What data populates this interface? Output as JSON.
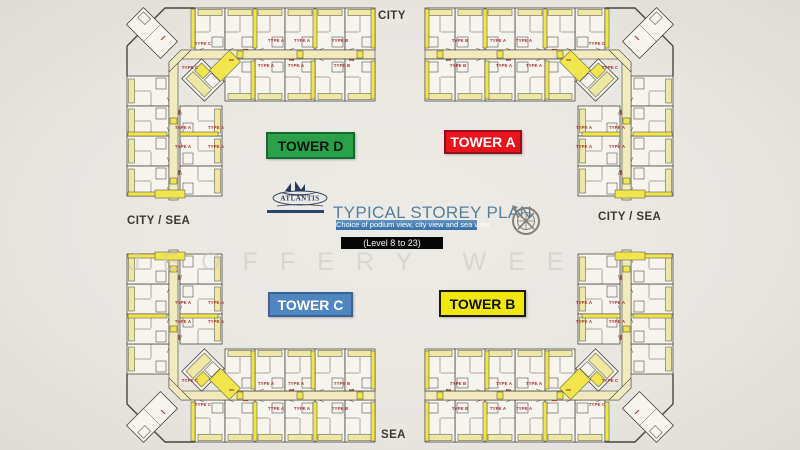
{
  "orientation": {
    "top": "CITY",
    "bottom": "SEA",
    "left": "CITY / SEA",
    "right": "CITY / SEA"
  },
  "towers": {
    "d": "TOWER D",
    "a": "TOWER A",
    "c": "TOWER C",
    "b": "TOWER B"
  },
  "branding": {
    "logo_text": "ATLANTIS",
    "title": "TYPICAL STOREY PLAN",
    "subtitle": "Choice of podium view, city view and sea view",
    "level_range": "(Level 8 to 23)"
  },
  "watermark": {
    "text": "JEOFFERY WEE"
  },
  "icons": {
    "compass": "compass-rose-icon"
  },
  "colors": {
    "tower_d": "#2aa148",
    "tower_a": "#e8131b",
    "tower_c": "#4f86c0",
    "tower_b": "#f0e70c",
    "title_text": "#54809e",
    "banner_bg": "#356fa6",
    "level_badge_bg": "#070707",
    "plan_highlight_yellow": "#f1e54e",
    "plan_pale_yellow": "#efe8a2",
    "plan_line": "#4a473e",
    "unit_label_red": "#ab352c",
    "background": "#e9e7e2"
  },
  "plan": {
    "unit_labels": [
      {
        "label": "TYPE C",
        "x": 203,
        "y": 45
      },
      {
        "label": "TYPE C",
        "x": 190,
        "y": 69
      },
      {
        "label": "TYPE A",
        "x": 276,
        "y": 42
      },
      {
        "label": "TYPE A",
        "x": 302,
        "y": 42
      },
      {
        "label": "TYPE A",
        "x": 266,
        "y": 67
      },
      {
        "label": "TYPE A",
        "x": 296,
        "y": 67
      },
      {
        "label": "TYPE B",
        "x": 340,
        "y": 42
      },
      {
        "label": "TYPE B",
        "x": 342,
        "y": 67
      },
      {
        "label": "TYPE A",
        "x": 183,
        "y": 129
      },
      {
        "label": "TYPE A",
        "x": 216,
        "y": 129
      },
      {
        "label": "TYPE A",
        "x": 183,
        "y": 148
      },
      {
        "label": "TYPE A",
        "x": 216,
        "y": 148
      },
      {
        "label": "TYPE C",
        "x": 597,
        "y": 45
      },
      {
        "label": "TYPE C",
        "x": 610,
        "y": 69
      },
      {
        "label": "TYPE A",
        "x": 524,
        "y": 42
      },
      {
        "label": "TYPE A",
        "x": 498,
        "y": 42
      },
      {
        "label": "TYPE A",
        "x": 534,
        "y": 67
      },
      {
        "label": "TYPE A",
        "x": 504,
        "y": 67
      },
      {
        "label": "TYPE B",
        "x": 460,
        "y": 42
      },
      {
        "label": "TYPE B",
        "x": 458,
        "y": 67
      },
      {
        "label": "TYPE A",
        "x": 617,
        "y": 129
      },
      {
        "label": "TYPE A",
        "x": 584,
        "y": 129
      },
      {
        "label": "TYPE A",
        "x": 617,
        "y": 148
      },
      {
        "label": "TYPE A",
        "x": 584,
        "y": 148
      },
      {
        "label": "TYPE C",
        "x": 203,
        "y": 406
      },
      {
        "label": "TYPE C",
        "x": 190,
        "y": 382
      },
      {
        "label": "TYPE A",
        "x": 276,
        "y": 410
      },
      {
        "label": "TYPE A",
        "x": 302,
        "y": 410
      },
      {
        "label": "TYPE A",
        "x": 266,
        "y": 385
      },
      {
        "label": "TYPE A",
        "x": 296,
        "y": 385
      },
      {
        "label": "TYPE B",
        "x": 340,
        "y": 410
      },
      {
        "label": "TYPE B",
        "x": 342,
        "y": 385
      },
      {
        "label": "TYPE A",
        "x": 183,
        "y": 323
      },
      {
        "label": "TYPE A",
        "x": 216,
        "y": 323
      },
      {
        "label": "TYPE A",
        "x": 183,
        "y": 304
      },
      {
        "label": "TYPE A",
        "x": 216,
        "y": 304
      },
      {
        "label": "TYPE C",
        "x": 597,
        "y": 406
      },
      {
        "label": "TYPE C",
        "x": 610,
        "y": 382
      },
      {
        "label": "TYPE A",
        "x": 524,
        "y": 410
      },
      {
        "label": "TYPE A",
        "x": 498,
        "y": 410
      },
      {
        "label": "TYPE A",
        "x": 534,
        "y": 385
      },
      {
        "label": "TYPE A",
        "x": 504,
        "y": 385
      },
      {
        "label": "TYPE B",
        "x": 460,
        "y": 410
      },
      {
        "label": "TYPE B",
        "x": 458,
        "y": 385
      },
      {
        "label": "TYPE A",
        "x": 617,
        "y": 323
      },
      {
        "label": "TYPE A",
        "x": 584,
        "y": 323
      },
      {
        "label": "TYPE A",
        "x": 617,
        "y": 304
      },
      {
        "label": "TYPE A",
        "x": 584,
        "y": 304
      }
    ]
  }
}
